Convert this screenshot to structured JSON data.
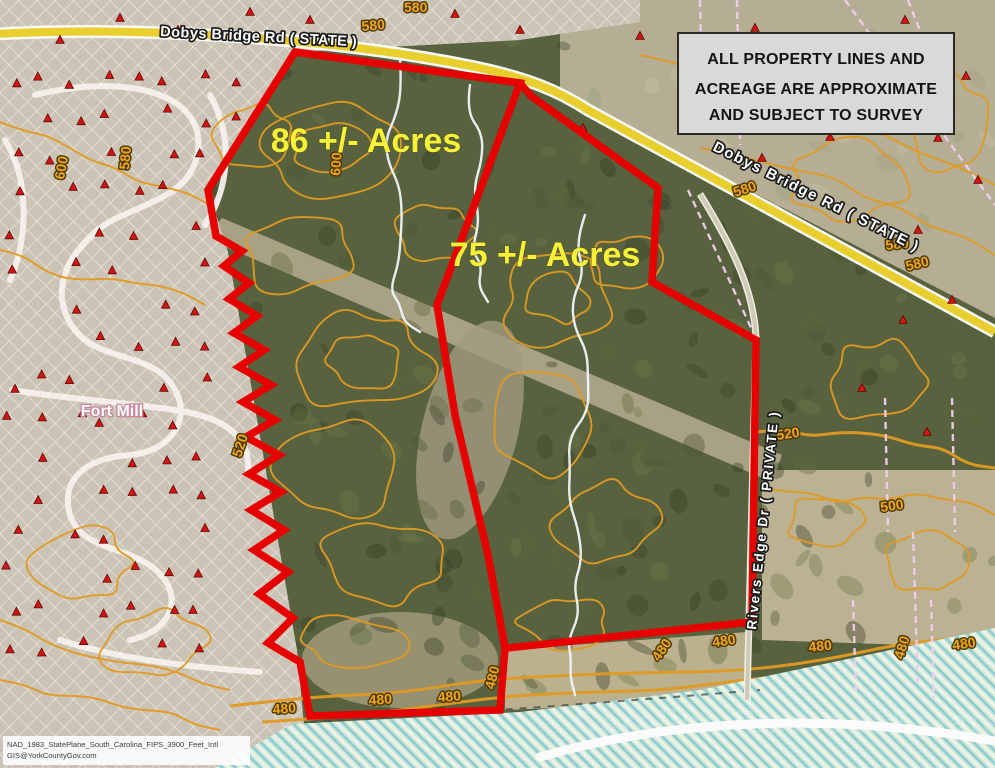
{
  "map": {
    "parcel_labels": [
      {
        "text": "86 +/- Acres",
        "x": 366,
        "y": 152
      },
      {
        "text": "75 +/- Acres",
        "x": 545,
        "y": 266
      }
    ],
    "roads": {
      "dobys_top": {
        "text": "Dobys Bridge Rd ( STATE )"
      },
      "dobys_right": {
        "text": "Dobys Bridge Rd ( STATE )"
      },
      "rivers_edge": {
        "text": "Rivers Edge Dr ( PRIVATE )"
      }
    },
    "city_label": {
      "text": "Fort Mill"
    },
    "watermark": {
      "text": "Carolina Farms & Estates"
    },
    "contour_labels": [
      {
        "t": "600",
        "x": 64,
        "y": 180,
        "r": -80
      },
      {
        "t": "580",
        "x": 129,
        "y": 170,
        "r": -85
      },
      {
        "t": "600",
        "x": 340,
        "y": 176,
        "r": -86
      },
      {
        "t": "580",
        "x": 362,
        "y": 31,
        "r": -5
      },
      {
        "t": "580",
        "x": 404,
        "y": 12,
        "r": 0
      },
      {
        "t": "580",
        "x": 735,
        "y": 197,
        "r": -18
      },
      {
        "t": "580",
        "x": 886,
        "y": 250,
        "r": -6
      },
      {
        "t": "580",
        "x": 907,
        "y": 271,
        "r": -14
      },
      {
        "t": "520",
        "x": 241,
        "y": 458,
        "r": -72
      },
      {
        "t": "520",
        "x": 777,
        "y": 440,
        "r": -8
      },
      {
        "t": "500",
        "x": 881,
        "y": 512,
        "r": -8
      },
      {
        "t": "480",
        "x": 273,
        "y": 714,
        "r": -4
      },
      {
        "t": "480",
        "x": 369,
        "y": 705,
        "r": -4
      },
      {
        "t": "480",
        "x": 438,
        "y": 702,
        "r": -4
      },
      {
        "t": "480",
        "x": 494,
        "y": 690,
        "r": -76
      },
      {
        "t": "480",
        "x": 659,
        "y": 662,
        "r": -56
      },
      {
        "t": "480",
        "x": 713,
        "y": 647,
        "r": -8
      },
      {
        "t": "480",
        "x": 809,
        "y": 652,
        "r": -6
      },
      {
        "t": "480",
        "x": 903,
        "y": 660,
        "r": -73
      },
      {
        "t": "480",
        "x": 953,
        "y": 650,
        "r": -8
      }
    ]
  },
  "disclaimer": {
    "line1": "ALL PROPERTY LINES AND",
    "line2": "ACREAGE ARE APPROXIMATE",
    "line3": "AND SUBJECT TO SURVEY"
  },
  "attribution": {
    "line1": "NAD_1983_StatePlane_South_Carolina_FIPS_3900_Feet_Intl",
    "line2": "GIS@YorkCountyGov.com"
  },
  "colors": {
    "boundary_red": "#e60000",
    "contour_orange": "#e09a22",
    "acre_yellow": "#f8f13a",
    "road_yellow": "#e9cf2e",
    "disclaimer_bg": "#d9d9d9",
    "river_teal": "#8fcfd4"
  }
}
